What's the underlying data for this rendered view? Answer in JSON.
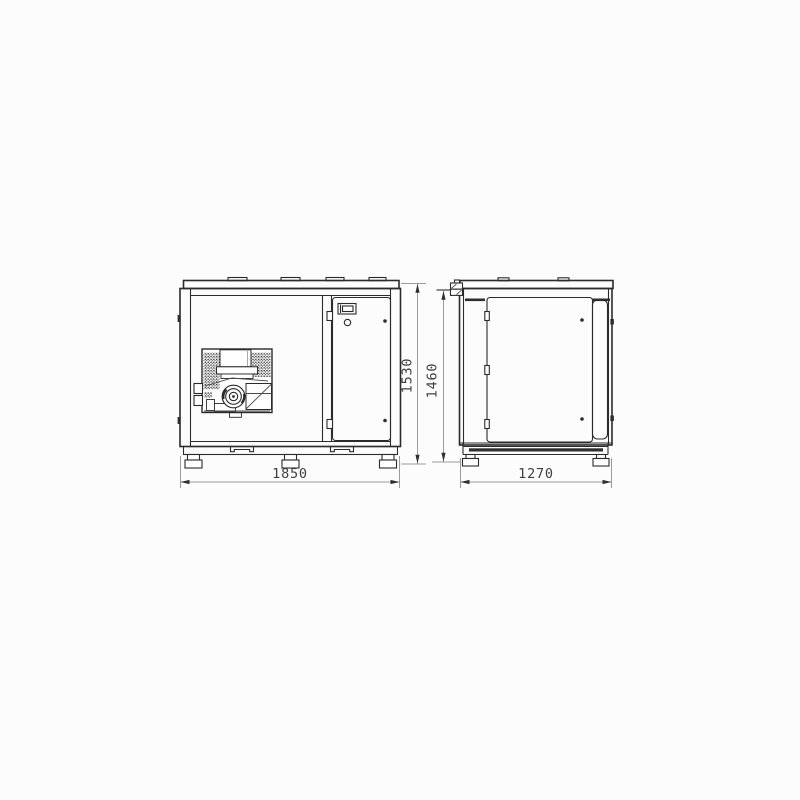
{
  "page": {
    "background": "#fcfcfc"
  },
  "drawing": {
    "type": "technical-dimension-drawing",
    "subject": "enclosed cabinet unit shown in front and side elevation views",
    "colors": {
      "line": "#2b2b2b",
      "dim_line": "#9b9b9b",
      "dim_text": "#3f3f3f",
      "background": "#fcfcfc"
    },
    "dimensions": {
      "front_width": "1850",
      "side_depth": "1270",
      "overall_height": "1530",
      "body_height": "1460"
    }
  }
}
